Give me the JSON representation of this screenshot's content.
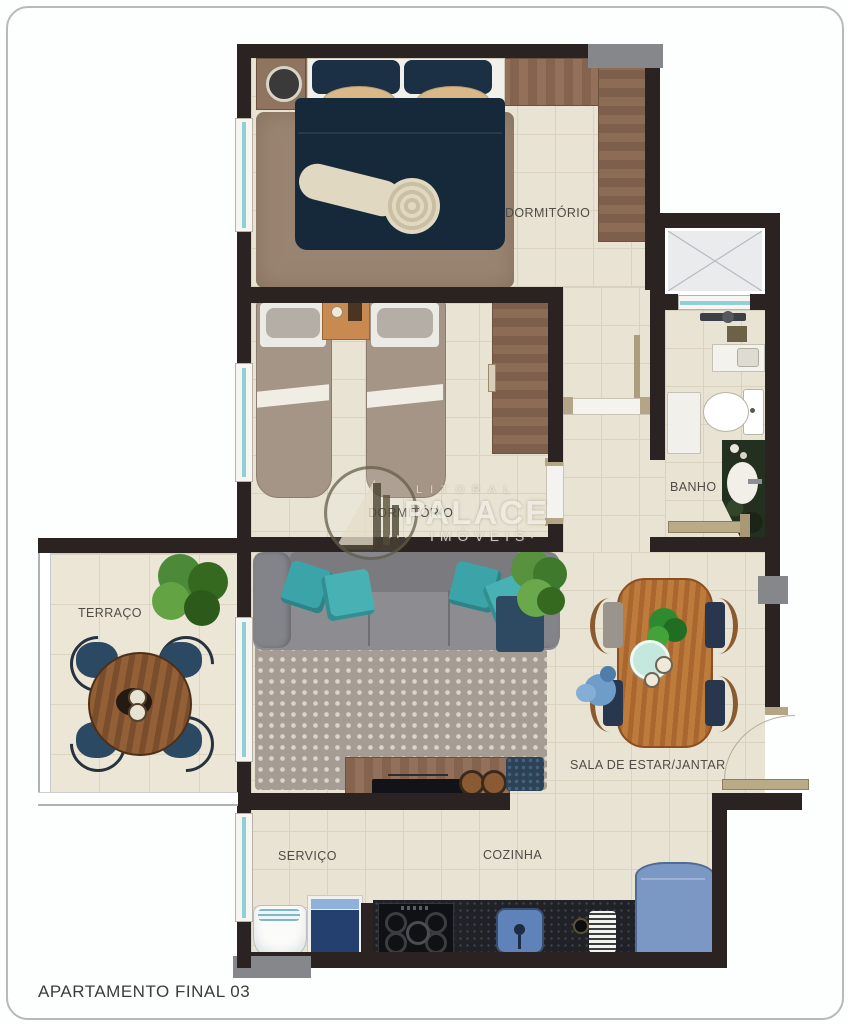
{
  "title": "APARTAMENTO FINAL 03",
  "rooms": {
    "master_bedroom": "DORMITÓRIO",
    "second_bedroom": "DORMITÓRIO",
    "bathroom": "BANHO",
    "terrace": "TERRAÇO",
    "living": "SALA DE ESTAR/JANTAR",
    "service": "SERVIÇO",
    "kitchen": "COZINHA"
  },
  "watermark": {
    "top": "LITORAL",
    "main": "PALACE",
    "sub": "IMÓVEIS",
    "left_dots": "‣ ‣ ‣",
    "right_arrow": "⟶"
  },
  "colors": {
    "wall": "#2b2322",
    "floor_tile": "#e8e3d2",
    "window_glass": "#8fd0d4",
    "bed_navy": "#16293b",
    "pillow_teal": "#3aa4a8",
    "wood_furniture": "#8a5a30",
    "appliance_blue": "#7b97c4",
    "counter_dark": "#202228",
    "structural_gray": "#85878a"
  }
}
